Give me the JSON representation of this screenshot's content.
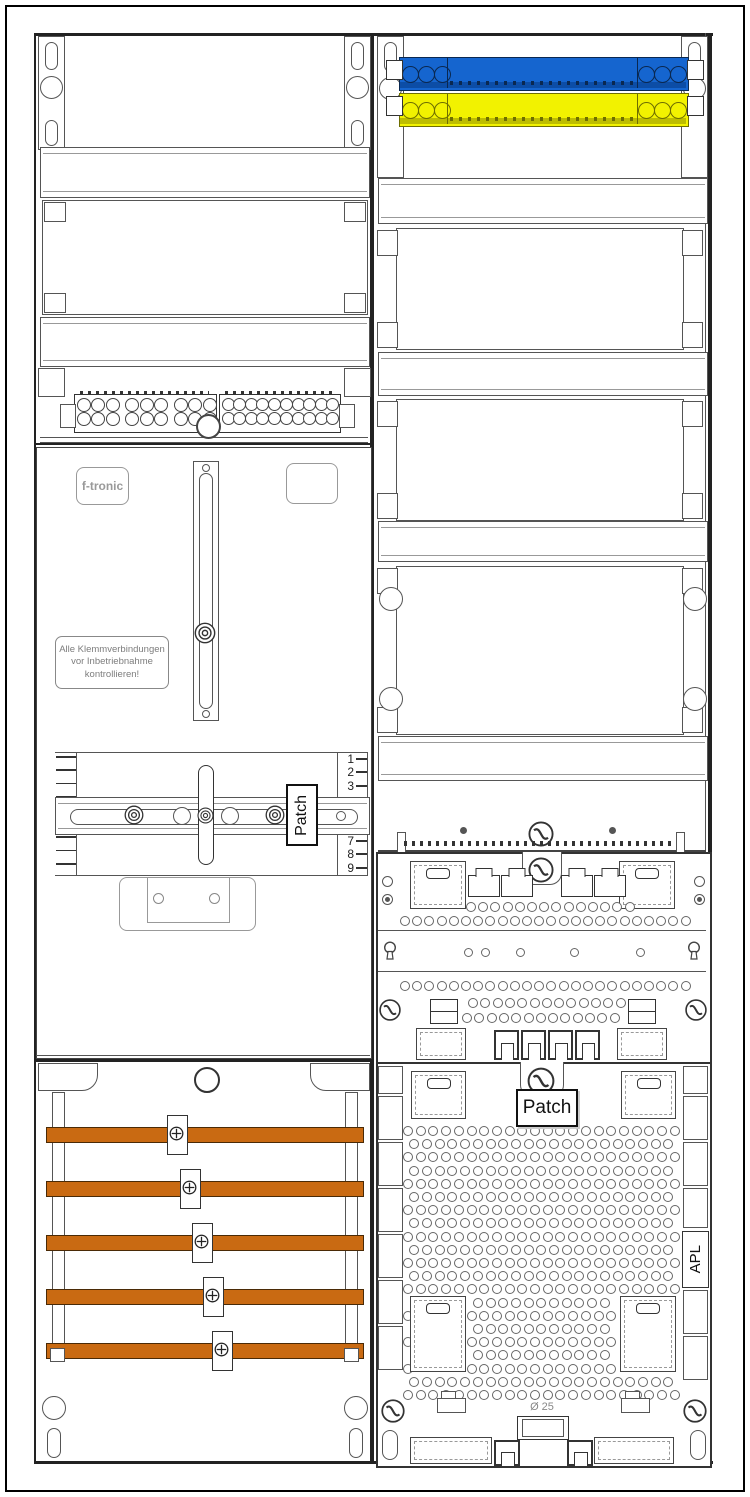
{
  "labels": {
    "brand": "f-tronic",
    "warning": {
      "line1": "Alle Klemmverbindungen",
      "line2": "vor Inbetriebnahme",
      "line3": "kontrollieren!"
    },
    "patch_left": "Patch",
    "patch_right": "Patch",
    "apl": "APL",
    "gland_diameter": "Ø 25"
  },
  "ruler": {
    "top_numbers": [
      "1",
      "2",
      "3"
    ],
    "bottom_numbers": [
      "7",
      "8",
      "9"
    ]
  },
  "colors": {
    "blue_busbar": "#1565CF",
    "blue_busbar_dark": "#0C4DA6",
    "yellow_busbar": "#F2F200",
    "yellow_busbar_dark": "#BDBD00",
    "copper_busbar": "#C96A12",
    "outline": "#333333",
    "grey_label": "#8a8a8a"
  },
  "counts": {
    "copper_busbars": 5,
    "blue_busbar_end_holes": 3,
    "yellow_busbar_end_holes": 3,
    "left_terminal_block_holes": 18,
    "right_terminal_block_holes": 20
  }
}
